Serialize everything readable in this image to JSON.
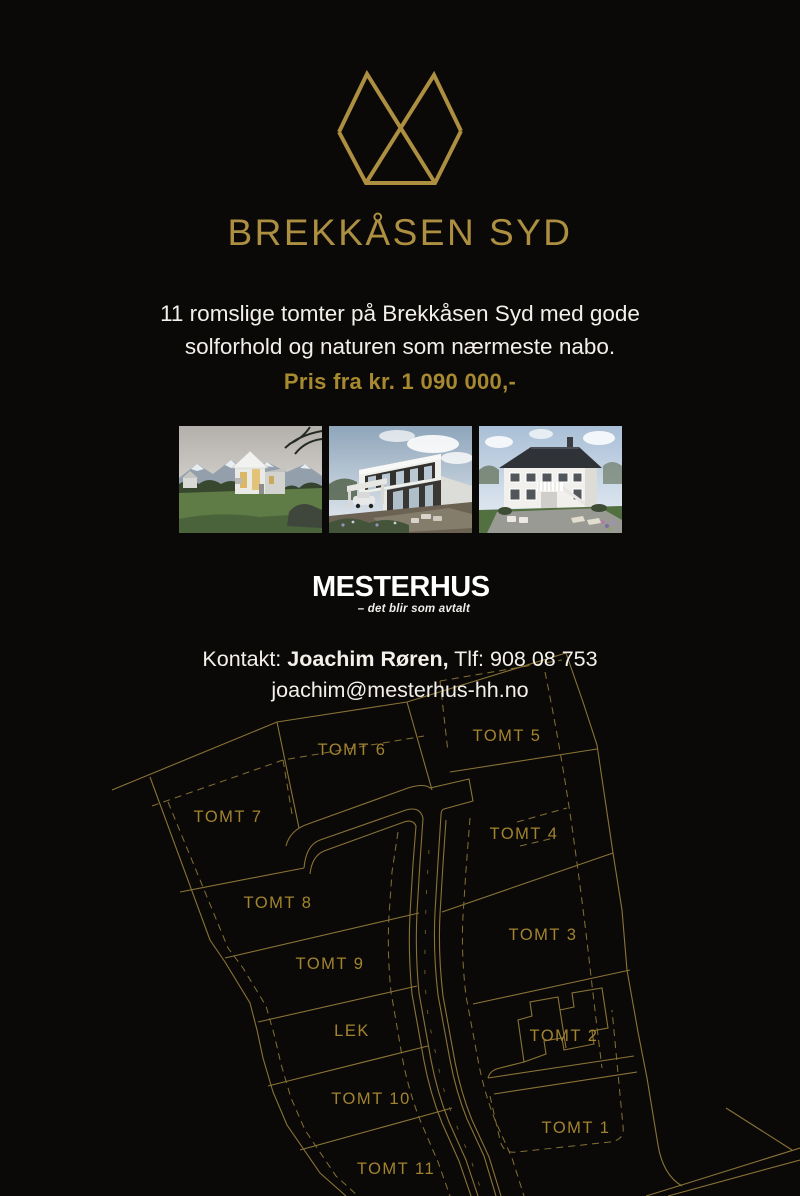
{
  "page": {
    "background_color": "#0a0907",
    "accent_gold": "#ad8f41",
    "price_gold": "#a7892f",
    "map_line_color": "#8a7336",
    "map_label_color": "#a2842f",
    "text_white": "#f3f0ea"
  },
  "brand": {
    "title": "BREKKÅSEN SYD",
    "logo_icon": "twin-peaks-diamond-icon"
  },
  "intro": {
    "line1": "11 romslige tomter på Brekkåsen Syd med gode",
    "line2": "solforhold og naturen som nærmeste nabo.",
    "price": "Pris fra kr. 1 090 000,-"
  },
  "photos": [
    {
      "name": "modern-gable-house-with-mountains-photo"
    },
    {
      "name": "modern-flat-roof-house-with-carport-photo"
    },
    {
      "name": "classic-white-two-storey-house-photo"
    }
  ],
  "builder": {
    "logo_text": "MESTERHUS",
    "tagline": "– det blir som avtalt"
  },
  "contact": {
    "label": "Kontakt:",
    "name": "Joachim Røren,",
    "phone": "Tlf: 908 08 753",
    "email": "joachim@mesterhus-hh.no"
  },
  "site_plan": {
    "labels": [
      {
        "text": "TOMT 6",
        "x": 352,
        "y": 755
      },
      {
        "text": "TOMT 5",
        "x": 507,
        "y": 741
      },
      {
        "text": "TOMT 7",
        "x": 228,
        "y": 822
      },
      {
        "text": "TOMT 4",
        "x": 524,
        "y": 839
      },
      {
        "text": "TOMT 8",
        "x": 278,
        "y": 908
      },
      {
        "text": "TOMT 3",
        "x": 543,
        "y": 940
      },
      {
        "text": "TOMT 9",
        "x": 330,
        "y": 969
      },
      {
        "text": "LEK",
        "x": 352,
        "y": 1036
      },
      {
        "text": "TOMT 2",
        "x": 564,
        "y": 1041
      },
      {
        "text": "TOMT 10",
        "x": 371,
        "y": 1104
      },
      {
        "text": "TOMT 1",
        "x": 576,
        "y": 1133
      },
      {
        "text": "TOMT 11",
        "x": 396,
        "y": 1174
      }
    ]
  }
}
